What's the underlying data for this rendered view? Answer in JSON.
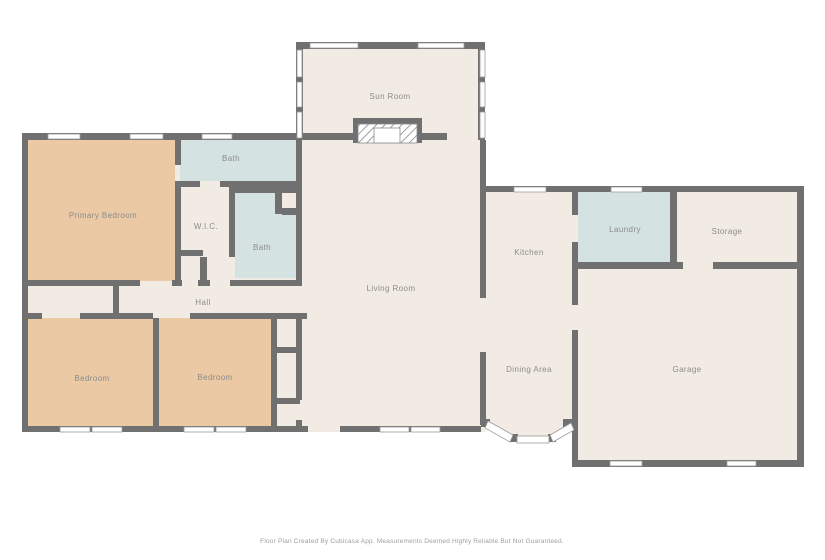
{
  "title": "Floor Plan",
  "colors": {
    "background": "#ffffff",
    "wall": "#707070",
    "floor": "#f2ebe4",
    "bedroom": "#eac9a4",
    "bath": "#d5e2e2",
    "label": "#8c8c8c",
    "footer": "#9e9e9e",
    "window_frame": "#9b9b9b"
  },
  "rooms": {
    "sun_room": {
      "label": "Sun Room"
    },
    "living_room": {
      "label": "Living Room"
    },
    "primary_bedroom": {
      "label": "Primary Bedroom"
    },
    "bath_top": {
      "label": "Bath"
    },
    "bath_inner": {
      "label": "Bath"
    },
    "wic": {
      "label": "W.I.C."
    },
    "hall": {
      "label": "Hall"
    },
    "bedroom_left": {
      "label": "Bedroom"
    },
    "bedroom_right": {
      "label": "Bedroom"
    },
    "kitchen": {
      "label": "Kitchen"
    },
    "dining": {
      "label": "Dining Area"
    },
    "laundry": {
      "label": "Laundry"
    },
    "storage": {
      "label": "Storage"
    },
    "garage": {
      "label": "Garage"
    }
  },
  "footer": {
    "text": "Floor Plan Created By Cubicasa App. Measurements Deemed Highly Reliable But Not Guaranteed."
  }
}
